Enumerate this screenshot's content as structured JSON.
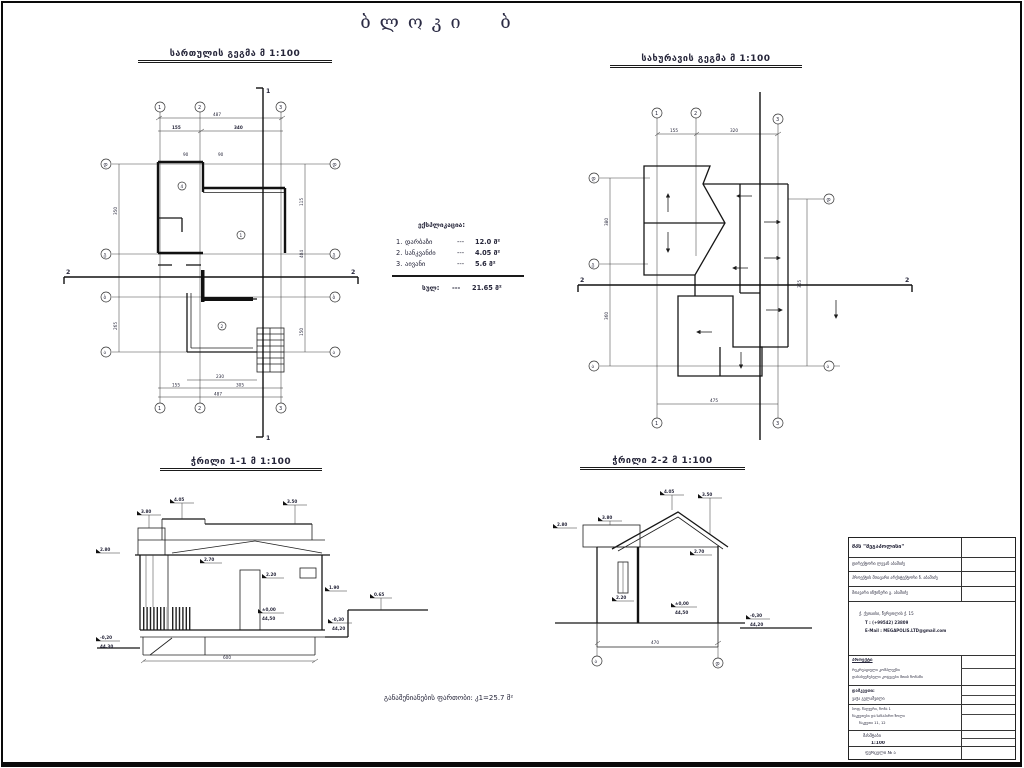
{
  "page": {
    "title": "ბლოკი ბ"
  },
  "floor_plan": {
    "title": "სართულის გეგმა მ 1:100",
    "axes_top": [
      "1",
      "2",
      "3"
    ],
    "axes_left": [
      "დ",
      "გ",
      "ბ",
      "ა"
    ],
    "rooms": [
      "4",
      "1",
      "2"
    ],
    "dims": {
      "top_total": "487",
      "top_a": "155",
      "top_b": "340",
      "bottom_a": "230",
      "bottom_b": "155",
      "bottom_c": "305",
      "bottom_total": "487",
      "left_a": "350",
      "left_b": "265",
      "right_a": "115",
      "right_b": "404",
      "right_c": "150",
      "small": "90"
    },
    "section_v": "1",
    "section_h": "2"
  },
  "roof_plan": {
    "title": "სახურავის გეგმა მ 1:100",
    "axes_top": [
      "1",
      "2",
      "3"
    ],
    "axes_bottom": [
      "1",
      "3"
    ],
    "axes_left": [
      "დ",
      "გ",
      "ა"
    ],
    "axes_right": [
      "დ",
      "ა"
    ],
    "dims": {
      "top_a": "155",
      "top_b": "320",
      "bottom": "475",
      "left_a": "380",
      "left_b": "360",
      "right_a": "365"
    },
    "section_h": "2"
  },
  "section1": {
    "title": "ჭრილი 1-1 მ 1:100",
    "marks": {
      "m280": "2.80",
      "m380": "3.80",
      "m405": "4.05",
      "m350": "3.50",
      "m270": "2.70",
      "m220": "2.20",
      "m190": "1.90",
      "m065": "0.65",
      "zero": "±0,00",
      "zero_abs": "44,50",
      "left_rel": "-0,20",
      "left_abs": "44,30",
      "right_rel": "-0,30",
      "right_abs": "44,20",
      "width": "600"
    }
  },
  "section2": {
    "title": "ჭრილი 2-2 მ 1:100",
    "marks": {
      "m280": "2.80",
      "m380": "3.80",
      "m405": "4.05",
      "m350": "3.50",
      "m270": "2.70",
      "m220": "2.20",
      "zero": "±0,00",
      "zero_abs": "44,50",
      "right_rel": "-0,30",
      "right_abs": "44,20",
      "width": "470"
    },
    "axes": [
      "ა",
      "დ"
    ]
  },
  "explication": {
    "title": "ექსპლიკაცია:",
    "items": [
      {
        "no": "1.",
        "name": "დარბაზი",
        "dash": "---",
        "value": "12.0 მ²"
      },
      {
        "no": "2.",
        "name": "სანკვანძი",
        "dash": "---",
        "value": "4.05 მ²"
      },
      {
        "no": "3.",
        "name": "აივანი",
        "dash": "---",
        "value": "5.6 მ²"
      }
    ],
    "total_label": "სულ:",
    "total_dash": "---",
    "total_value": "21.65 მ²"
  },
  "footer_note": "განაშენიანების ფართობი: კ1=25.7 მ²",
  "title_block": {
    "company": "შპს \"მეგაპოლისი\"",
    "row2": "დირექტორი ლევან აბაშიძე",
    "row3": "პროექტის მთავარი არქიტექტორი ნ. აბაშიძე",
    "row4": "მთავარი ინჟინერი გ. აბაშიძე",
    "address": "ქ. ქუთაისი, წერეთლის ქ. 15",
    "phone": "T : (+99542) 23809",
    "email": "E-Mail : MEGAPOLIS.LTD@gmail.com",
    "project_label": "პროექტი",
    "project_line1": "რეკრეაციული კომპლექსი",
    "project_line2": "დასასვენებელი კოტეჯები მთის ზონაში",
    "client_label": "დამკვეთი:",
    "client_name": "ვაჟა გელაშვილი",
    "site_line1": "სოფ. წაღვერი, ზონა 1",
    "site_line2": "ნაკვეთები და სანაპირო ზოლი",
    "site_line3": "ნაკვეთი 11, 12",
    "scale_label": "მასშტაბი",
    "scale_value": "1:100",
    "sheet_label": "ფურცელი № ა"
  }
}
